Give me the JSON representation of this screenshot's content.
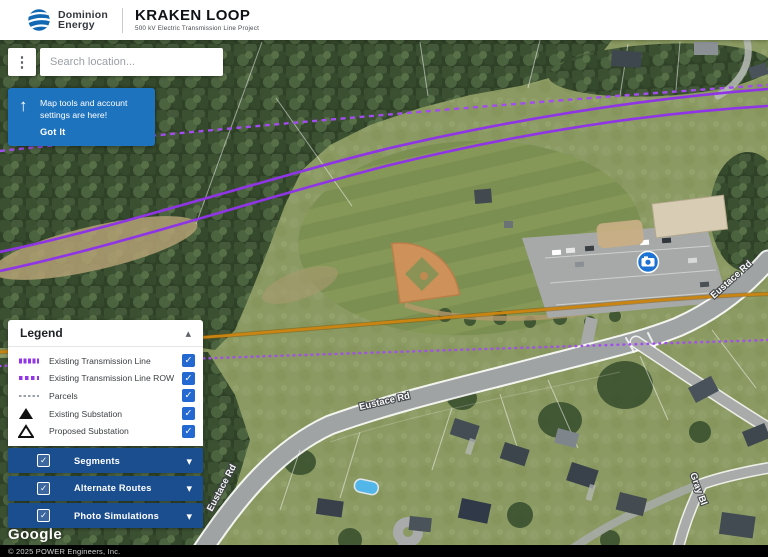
{
  "header": {
    "brand": {
      "name_line1": "Dominion",
      "name_line2": "Energy"
    },
    "project": {
      "title": "KRAKEN LOOP",
      "subtitle": "500 kV Electric Transmission Line Project"
    }
  },
  "toolbar": {
    "search_placeholder": "Search location..."
  },
  "tooltip": {
    "text_line1": "Map tools and account",
    "text_line2": "settings are here!",
    "dismiss_label": "Got It"
  },
  "legend": {
    "title": "Legend",
    "items": [
      {
        "label": "Existing Transmission Line",
        "swatch": "purple-solid-line",
        "checked": true
      },
      {
        "label": "Existing Transmission Line ROW",
        "swatch": "purple-dashed-line",
        "checked": true
      },
      {
        "label": "Parcels",
        "swatch": "gray-dashed-line",
        "checked": true
      },
      {
        "label": "Existing Substation",
        "swatch": "black-filled-triangle",
        "checked": true
      },
      {
        "label": "Proposed Substation",
        "swatch": "black-outline-triangle",
        "checked": true
      }
    ]
  },
  "layer_panels": [
    {
      "label": "Segments",
      "checked": true
    },
    {
      "label": "Alternate Routes",
      "checked": true
    },
    {
      "label": "Photo Simulations",
      "checked": true
    }
  ],
  "map": {
    "road_labels": {
      "eustace_mid": "Eustace Rd",
      "eustace_sw": "Eustace Rd",
      "eustace_ne": "Eustace Rd",
      "gray_st": "Gray Bl"
    },
    "attribution_logo": "Google"
  },
  "footer": {
    "copyright": "© 2025 POWER Engineers, Inc."
  },
  "colors": {
    "accent_blue": "#1e73be",
    "panel_blue": "#1b4e8f",
    "checkbox_blue": "#2468d2",
    "transmission_purple": "#8f35e6",
    "row_purple": "#a34df0",
    "segment_orange": "#c98412",
    "dominion_blue": "#1268b3"
  }
}
